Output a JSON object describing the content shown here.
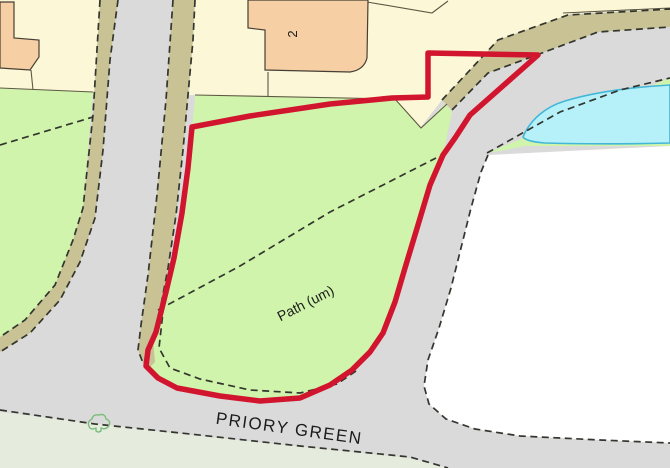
{
  "map": {
    "type": "site-location-plan",
    "labels": {
      "building_number": "2",
      "path": "Path (um)",
      "street": "PRIORY GREEN"
    },
    "symbols": {
      "shrub": "small bush/shrub outline symbol"
    },
    "palette": {
      "road-grey": "#dadada",
      "cream": "#fcf7d6",
      "building-orange": "#f6cfa4",
      "building-outline": "#453f35",
      "parcel-line": "#5d5844",
      "green": "#d0f4ab",
      "pale-green": "#e5ecdd",
      "verge-olive": "#c8c295",
      "pond-fill": "#b6f1f9",
      "pond-stroke": "#43b7d8",
      "white-parcel": "#ffffff",
      "dash-line": "#33362e",
      "boundary-red": "#d2152e",
      "shrub-green": "#7bbd7b"
    }
  }
}
